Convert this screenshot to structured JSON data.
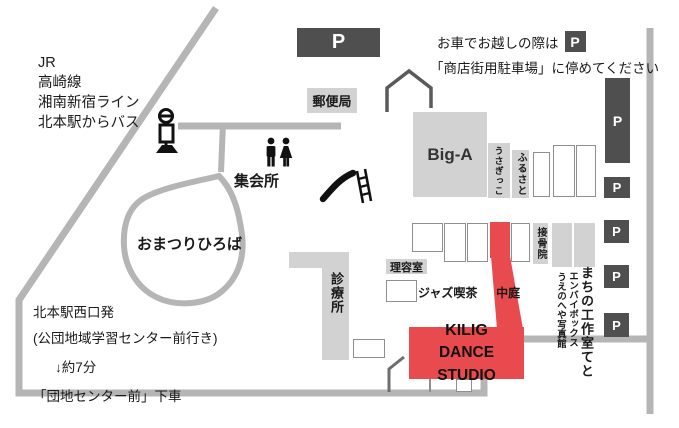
{
  "colors": {
    "accent_red": "#e84a4e",
    "road_gray": "#b5b5b5",
    "building_gray": "#d2d2d2",
    "dark_gray": "#4f4f4f"
  },
  "parking_label": "P",
  "access": {
    "train_lines": [
      "JR",
      "高崎線",
      "湘南新宿ライン",
      "北本駅からバス"
    ],
    "bus_route": [
      "北本駅西口発",
      "(公団地域学習センター前行き)",
      "↓約7分",
      "「団地センター前」下車"
    ]
  },
  "car_note": {
    "line1": "お車でお越しの際は",
    "p_badge": "P",
    "line2": "「商店街用駐車場」に停めてください"
  },
  "places": {
    "post_office": "郵便局",
    "big_a": "Big-A",
    "usagikko": "うさぎっこ",
    "furusato": "ふるさと",
    "meeting_hall": "集会所",
    "festival_square": "おまつりひろば",
    "clinic": "診療所",
    "barber": "理容室",
    "jazz_cafe": "ジャズ喫茶",
    "courtyard": "中庭",
    "osteopathic_clinic": "接骨院",
    "machi_workshop": "まちの工作室てと",
    "envai_box": "エンバイボックス",
    "uenoheya_photo": "うえのへや写真館"
  },
  "studio": {
    "line1": "KILIG",
    "line2": "DANCE STUDIO"
  }
}
